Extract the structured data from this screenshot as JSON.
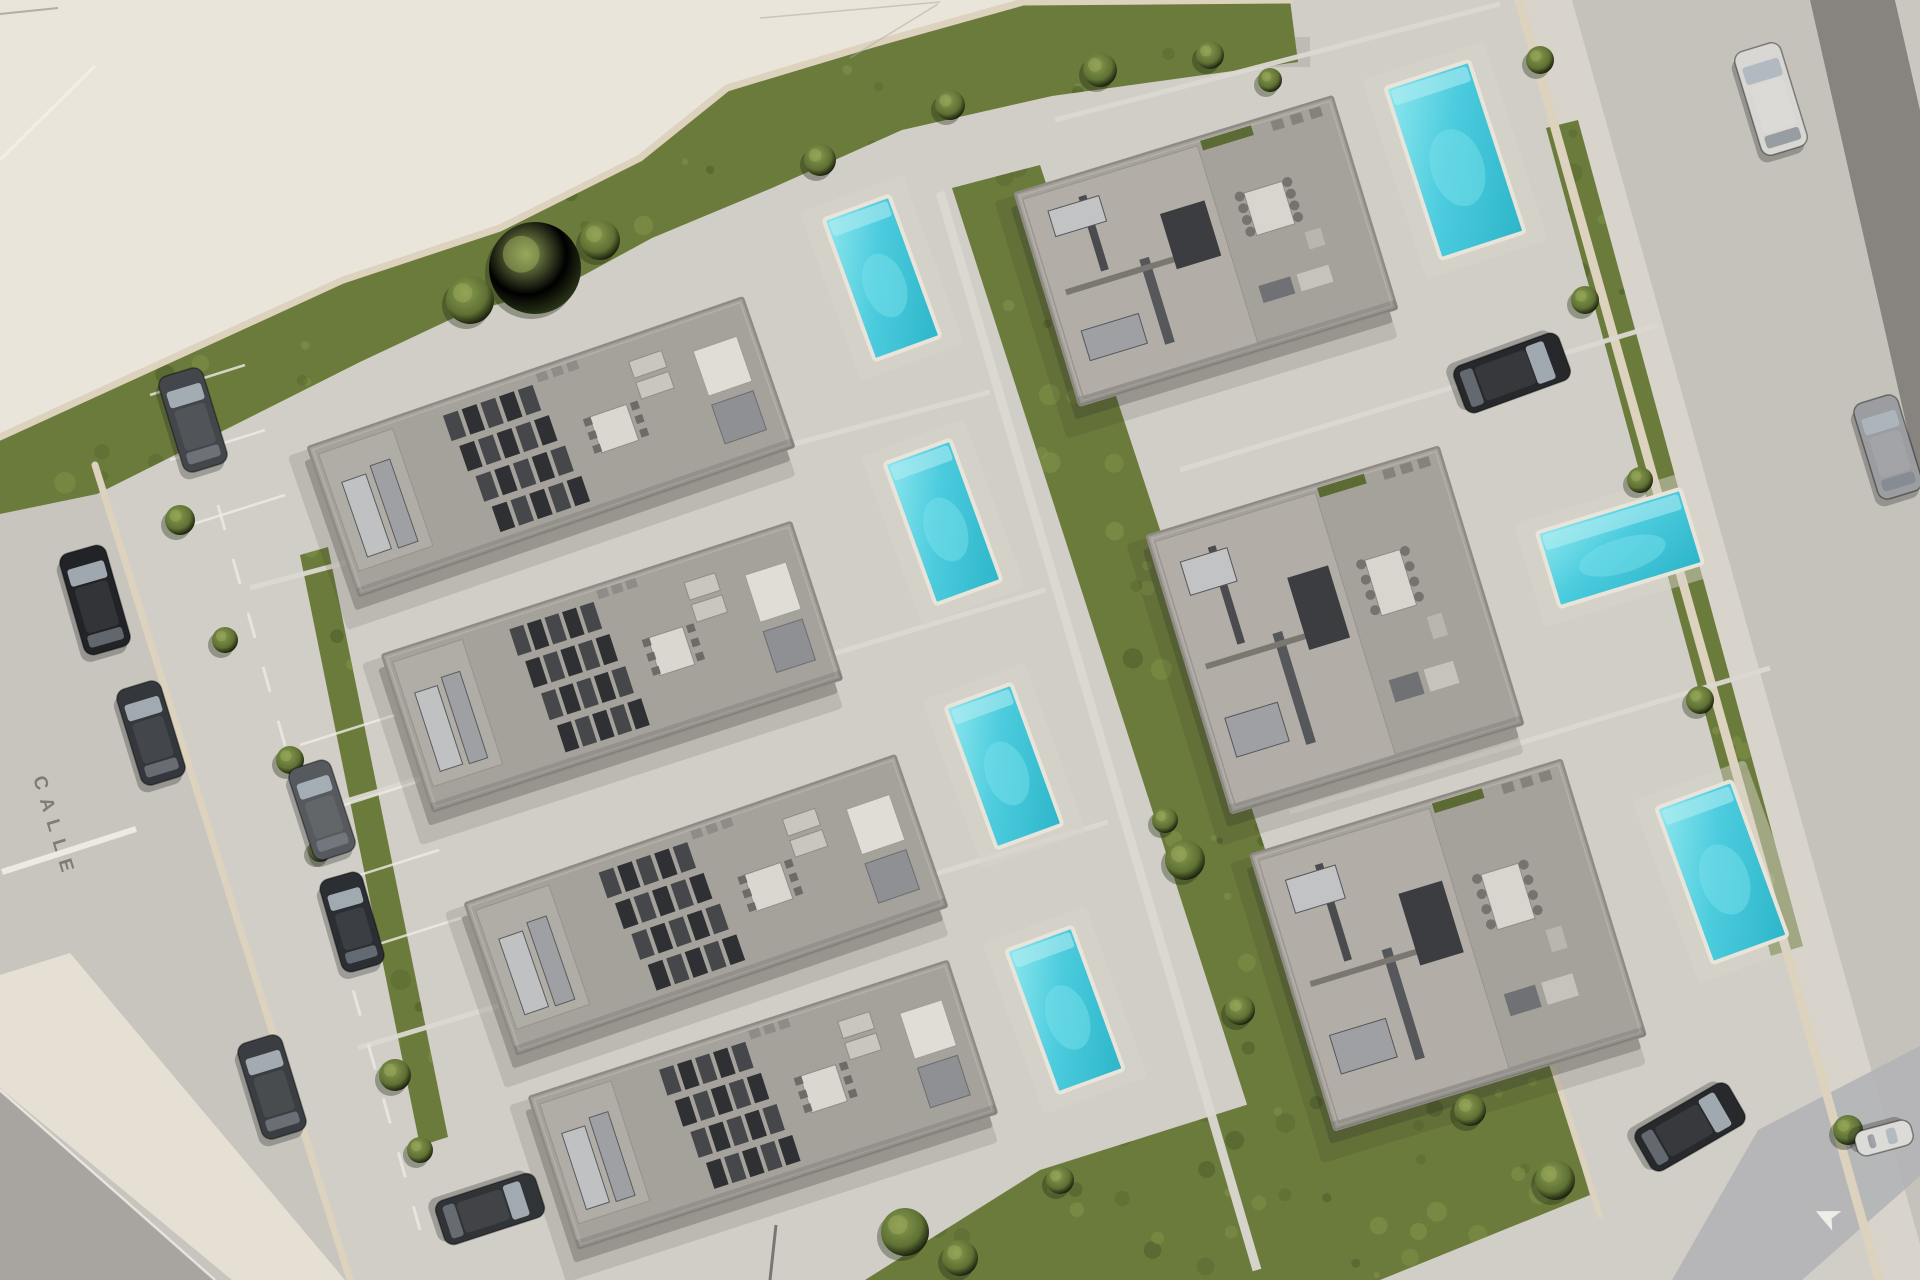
{
  "street_label": {
    "text": "CALLE",
    "color": "#6e6963"
  },
  "road_arrow": {
    "glyph": "➤",
    "color": "#f4f2ec"
  },
  "palette": {
    "street": "#c8c5bf",
    "site_pavement": "#d1cec7",
    "plaza": "#eae5da",
    "sidewalk": "#e6e0d4",
    "dark_road": "#a8a5a0",
    "median": "#7f7d78",
    "blue_patch": "#b2b4b6",
    "grass": "#6b7b3c",
    "grass_dark": "#4a5c29",
    "grass_light": "#84964a",
    "hedge": "#47592b",
    "wall": "#dcd2bd",
    "roof": "#a5a19b",
    "roof_light": "#b2aea7",
    "roof_dark": "#3e3f42",
    "pool_deep": "#2db5c9",
    "pool_mid": "#4cccde",
    "pool_light": "#8fe7ee",
    "marking_white": "#efece5"
  },
  "regions": {
    "plaza": [
      [
        0,
        0
      ],
      [
        1023,
        0
      ],
      [
        873,
        44
      ],
      [
        727,
        88
      ],
      [
        640,
        158
      ],
      [
        500,
        228
      ],
      [
        343,
        280
      ],
      [
        60,
        407
      ],
      [
        0,
        437
      ]
    ],
    "site": [
      [
        60,
        407
      ],
      [
        343,
        280
      ],
      [
        500,
        228
      ],
      [
        640,
        158
      ],
      [
        727,
        88
      ],
      [
        873,
        44
      ],
      [
        1023,
        2
      ],
      [
        1290,
        0
      ],
      [
        1519,
        0
      ],
      [
        1879,
        1280
      ],
      [
        350,
        1280
      ],
      [
        95,
        465
      ]
    ],
    "sidewalk_bl": [
      [
        0,
        975
      ],
      [
        70,
        953
      ],
      [
        345,
        1280
      ],
      [
        232,
        1280
      ],
      [
        0,
        1088
      ]
    ],
    "dark_road_bl": [
      [
        0,
        1092
      ],
      [
        215,
        1280
      ],
      [
        0,
        1280
      ]
    ],
    "sidewalk_right": [
      [
        1519,
        0
      ],
      [
        1572,
        0
      ],
      [
        1932,
        1280
      ],
      [
        1879,
        1280
      ]
    ],
    "road_right": [
      [
        1572,
        0
      ],
      [
        1920,
        0
      ],
      [
        1920,
        1280
      ],
      [
        1930,
        1280
      ]
    ],
    "median_right": [
      [
        1810,
        0
      ],
      [
        1895,
        0
      ],
      [
        1920,
        110
      ],
      [
        1920,
        485
      ]
    ],
    "corner_sliver": [
      [
        1895,
        0
      ],
      [
        1920,
        0
      ],
      [
        1920,
        110
      ]
    ],
    "blue_patch": [
      [
        1672,
        1280
      ],
      [
        1758,
        1130
      ],
      [
        1920,
        1046
      ],
      [
        1920,
        1176
      ],
      [
        1802,
        1280
      ]
    ]
  },
  "grass": [
    {
      "id": "grass-top-strip",
      "points": [
        [
          0,
          437
        ],
        [
          60,
          407
        ],
        [
          343,
          280
        ],
        [
          500,
          228
        ],
        [
          640,
          158
        ],
        [
          727,
          88
        ],
        [
          873,
          44
        ],
        [
          1023,
          2
        ],
        [
          1290,
          0
        ],
        [
          1298,
          62
        ],
        [
          1052,
          96
        ],
        [
          902,
          130
        ],
        [
          772,
          188
        ],
        [
          652,
          238
        ],
        [
          562,
          287
        ],
        [
          462,
          314
        ],
        [
          360,
          362
        ],
        [
          97,
          494
        ],
        [
          0,
          514
        ]
      ]
    },
    {
      "id": "grass-central-band",
      "points": [
        [
          952,
          188
        ],
        [
          1040,
          165
        ],
        [
          1345,
          1092
        ],
        [
          1252,
          1120
        ]
      ]
    },
    {
      "id": "grass-bottom-right",
      "points": [
        [
          865,
          1280
        ],
        [
          1040,
          1170
        ],
        [
          1300,
          1088
        ],
        [
          1545,
          1042
        ],
        [
          1590,
          1195
        ],
        [
          1380,
          1280
        ]
      ]
    },
    {
      "id": "grass-left-strip",
      "points": [
        [
          300,
          555
        ],
        [
          328,
          547
        ],
        [
          448,
          1137
        ],
        [
          420,
          1146
        ]
      ]
    },
    {
      "id": "hedge-right-wall",
      "points": [
        [
          1546,
          128
        ],
        [
          1578,
          120
        ],
        [
          1803,
          946
        ],
        [
          1771,
          956
        ]
      ]
    }
  ],
  "walls": [
    {
      "id": "wall-northwest",
      "points": [
        [
          0,
          437
        ],
        [
          343,
          280
        ],
        [
          500,
          228
        ],
        [
          640,
          158
        ],
        [
          727,
          88
        ],
        [
          873,
          44
        ],
        [
          1023,
          2
        ],
        [
          1290,
          0
        ]
      ],
      "width": 7
    },
    {
      "id": "wall-left",
      "points": [
        [
          95,
          465
        ],
        [
          350,
          1280
        ]
      ],
      "width": 7
    },
    {
      "id": "wall-right",
      "points": [
        [
          1519,
          0
        ],
        [
          1879,
          1280
        ]
      ],
      "width": 9
    },
    {
      "id": "wall-bottom-right",
      "points": [
        [
          1545,
          1042
        ],
        [
          1600,
          1215
        ]
      ],
      "width": 6
    }
  ],
  "dividers": [
    {
      "id": "lot-line-1",
      "x1": 250,
      "y1": 588,
      "x2": 990,
      "y2": 392
    },
    {
      "id": "lot-line-2",
      "x1": 300,
      "y1": 815,
      "x2": 1045,
      "y2": 590
    },
    {
      "id": "lot-line-3",
      "x1": 358,
      "y1": 1048,
      "x2": 1108,
      "y2": 822
    },
    {
      "id": "lot-line-4",
      "x1": 1180,
      "y1": 470,
      "x2": 1658,
      "y2": 325
    },
    {
      "id": "lot-line-5",
      "x1": 1290,
      "y1": 812,
      "x2": 1770,
      "y2": 668
    },
    {
      "id": "lot-line-6",
      "x1": 1055,
      "y1": 120,
      "x2": 1500,
      "y2": 4
    },
    {
      "id": "central-walkway",
      "x1": 940,
      "y1": 192,
      "x2": 1257,
      "y2": 1270
    }
  ],
  "markings": {
    "street_dash_line": {
      "x1": 218,
      "y1": 505,
      "x2": 420,
      "y2": 1230
    },
    "stop_line": {
      "x1": 2,
      "y1": 872,
      "x2": 136,
      "y2": 829
    },
    "curb_line_bl": {
      "x1": 0,
      "y1": 1090,
      "x2": 215,
      "y2": 1280
    },
    "plaza_line": {
      "x1": 0,
      "y1": 160,
      "x2": 95,
      "y2": 66
    },
    "bay_lines": [
      [
        150,
        395,
        245,
        365
      ],
      [
        170,
        460,
        265,
        430
      ],
      [
        190,
        525,
        285,
        495
      ],
      [
        300,
        745,
        395,
        715
      ],
      [
        322,
        812,
        417,
        782
      ],
      [
        344,
        880,
        439,
        850
      ],
      [
        366,
        948,
        461,
        918
      ]
    ]
  },
  "houses": [
    {
      "id": "house-1",
      "cx": 551,
      "cy": 447,
      "w": 460,
      "h": 158,
      "rot": -19,
      "variant": "slab"
    },
    {
      "id": "house-2",
      "cx": 612,
      "cy": 667,
      "w": 430,
      "h": 165,
      "rot": -18,
      "variant": "slab"
    },
    {
      "id": "house-3",
      "cx": 706,
      "cy": 905,
      "w": 455,
      "h": 160,
      "rot": -19,
      "variant": "slab"
    },
    {
      "id": "house-4",
      "cx": 763,
      "cy": 1105,
      "w": 440,
      "h": 160,
      "rot": -18,
      "variant": "slab"
    },
    {
      "id": "house-5",
      "cx": 1206,
      "cy": 251,
      "w": 332,
      "h": 222,
      "rot": -17,
      "variant": "villa"
    },
    {
      "id": "house-6",
      "cx": 1335,
      "cy": 630,
      "w": 305,
      "h": 290,
      "rot": -17,
      "variant": "villa"
    },
    {
      "id": "house-7",
      "cx": 1448,
      "cy": 945,
      "w": 325,
      "h": 288,
      "rot": -17,
      "variant": "villa"
    }
  ],
  "pools": [
    {
      "id": "pool-1",
      "cx": 882,
      "cy": 278,
      "w": 70,
      "h": 150,
      "rot": -20
    },
    {
      "id": "pool-2",
      "cx": 943,
      "cy": 522,
      "w": 70,
      "h": 150,
      "rot": -20
    },
    {
      "id": "pool-3",
      "cx": 1004,
      "cy": 766,
      "w": 70,
      "h": 150,
      "rot": -20
    },
    {
      "id": "pool-4",
      "cx": 1065,
      "cy": 1010,
      "w": 70,
      "h": 152,
      "rot": -20
    },
    {
      "id": "pool-5",
      "cx": 1455,
      "cy": 160,
      "w": 88,
      "h": 180,
      "rot": -18
    },
    {
      "id": "pool-6",
      "cx": 1620,
      "cy": 548,
      "w": 150,
      "h": 78,
      "rot": -17
    },
    {
      "id": "pool-7",
      "cx": 1722,
      "cy": 872,
      "w": 80,
      "h": 165,
      "rot": -20
    }
  ],
  "cars": [
    {
      "id": "car-1",
      "cx": 193,
      "cy": 420,
      "len": 100,
      "wid": 46,
      "rot": -17,
      "color": "#43464a"
    },
    {
      "id": "car-2",
      "cx": 95,
      "cy": 600,
      "len": 105,
      "wid": 48,
      "rot": -16,
      "color": "#212326"
    },
    {
      "id": "car-3",
      "cx": 151,
      "cy": 733,
      "len": 100,
      "wid": 46,
      "rot": -17,
      "color": "#34373b"
    },
    {
      "id": "car-4",
      "cx": 322,
      "cy": 810,
      "len": 96,
      "wid": 44,
      "rot": -18,
      "color": "#56595d"
    },
    {
      "id": "car-5",
      "cx": 352,
      "cy": 922,
      "len": 96,
      "wid": 44,
      "rot": -16,
      "color": "#2b2e32"
    },
    {
      "id": "car-6",
      "cx": 272,
      "cy": 1087,
      "len": 100,
      "wid": 46,
      "rot": -17,
      "color": "#3a3d41"
    },
    {
      "id": "car-7",
      "cx": 490,
      "cy": 1209,
      "len": 105,
      "wid": 46,
      "rot": 72,
      "color": "#313437"
    },
    {
      "id": "car-8",
      "cx": 1771,
      "cy": 99,
      "len": 108,
      "wid": 48,
      "rot": -17,
      "color": "#d8d7d3"
    },
    {
      "id": "car-9",
      "cx": 1512,
      "cy": 373,
      "len": 112,
      "wid": 50,
      "rot": 70,
      "color": "#26282b"
    },
    {
      "id": "car-10",
      "cx": 1888,
      "cy": 447,
      "len": 100,
      "wid": 46,
      "rot": -17,
      "color": "#9b9da0"
    },
    {
      "id": "car-11",
      "cx": 1690,
      "cy": 1127,
      "len": 108,
      "wid": 48,
      "rot": 60,
      "color": "#27292d"
    },
    {
      "id": "car-12",
      "cx": 1884,
      "cy": 1138,
      "len": 58,
      "wid": 26,
      "rot": 75,
      "color": "#dcdbd7"
    }
  ],
  "vegetation": [
    {
      "type": "tree",
      "cx": 535,
      "cy": 268,
      "r": 46
    },
    {
      "type": "bush",
      "cx": 470,
      "cy": 300,
      "r": 24
    },
    {
      "type": "bush",
      "cx": 600,
      "cy": 240,
      "r": 20
    },
    {
      "type": "bush",
      "cx": 820,
      "cy": 160,
      "r": 16
    },
    {
      "type": "bush",
      "cx": 950,
      "cy": 105,
      "r": 15
    },
    {
      "type": "bush",
      "cx": 1100,
      "cy": 70,
      "r": 17
    },
    {
      "type": "bush",
      "cx": 1210,
      "cy": 55,
      "r": 14
    },
    {
      "type": "bush",
      "cx": 1270,
      "cy": 80,
      "r": 12
    },
    {
      "type": "bush",
      "cx": 180,
      "cy": 520,
      "r": 15
    },
    {
      "type": "bush",
      "cx": 225,
      "cy": 640,
      "r": 13
    },
    {
      "type": "bush",
      "cx": 290,
      "cy": 760,
      "r": 14
    },
    {
      "type": "bush",
      "cx": 320,
      "cy": 850,
      "r": 12
    },
    {
      "type": "bush",
      "cx": 395,
      "cy": 1075,
      "r": 16
    },
    {
      "type": "bush",
      "cx": 420,
      "cy": 1150,
      "r": 13
    },
    {
      "type": "bush",
      "cx": 1185,
      "cy": 860,
      "r": 20
    },
    {
      "type": "bush",
      "cx": 1165,
      "cy": 820,
      "r": 13
    },
    {
      "type": "bush",
      "cx": 1240,
      "cy": 1010,
      "r": 15
    },
    {
      "type": "bush",
      "cx": 905,
      "cy": 1232,
      "r": 24
    },
    {
      "type": "bush",
      "cx": 960,
      "cy": 1258,
      "r": 18
    },
    {
      "type": "bush",
      "cx": 1060,
      "cy": 1180,
      "r": 14
    },
    {
      "type": "bush",
      "cx": 1470,
      "cy": 1110,
      "r": 16
    },
    {
      "type": "bush",
      "cx": 1555,
      "cy": 1180,
      "r": 20
    },
    {
      "type": "bush",
      "cx": 1585,
      "cy": 300,
      "r": 14
    },
    {
      "type": "bush",
      "cx": 1640,
      "cy": 480,
      "r": 13
    },
    {
      "type": "bush",
      "cx": 1700,
      "cy": 700,
      "r": 14
    },
    {
      "type": "bush",
      "cx": 1540,
      "cy": 60,
      "r": 14
    },
    {
      "type": "bush",
      "cx": 1848,
      "cy": 1130,
      "r": 15
    }
  ],
  "counts": {
    "houses": 7,
    "pools": 7,
    "cars": 12
  }
}
